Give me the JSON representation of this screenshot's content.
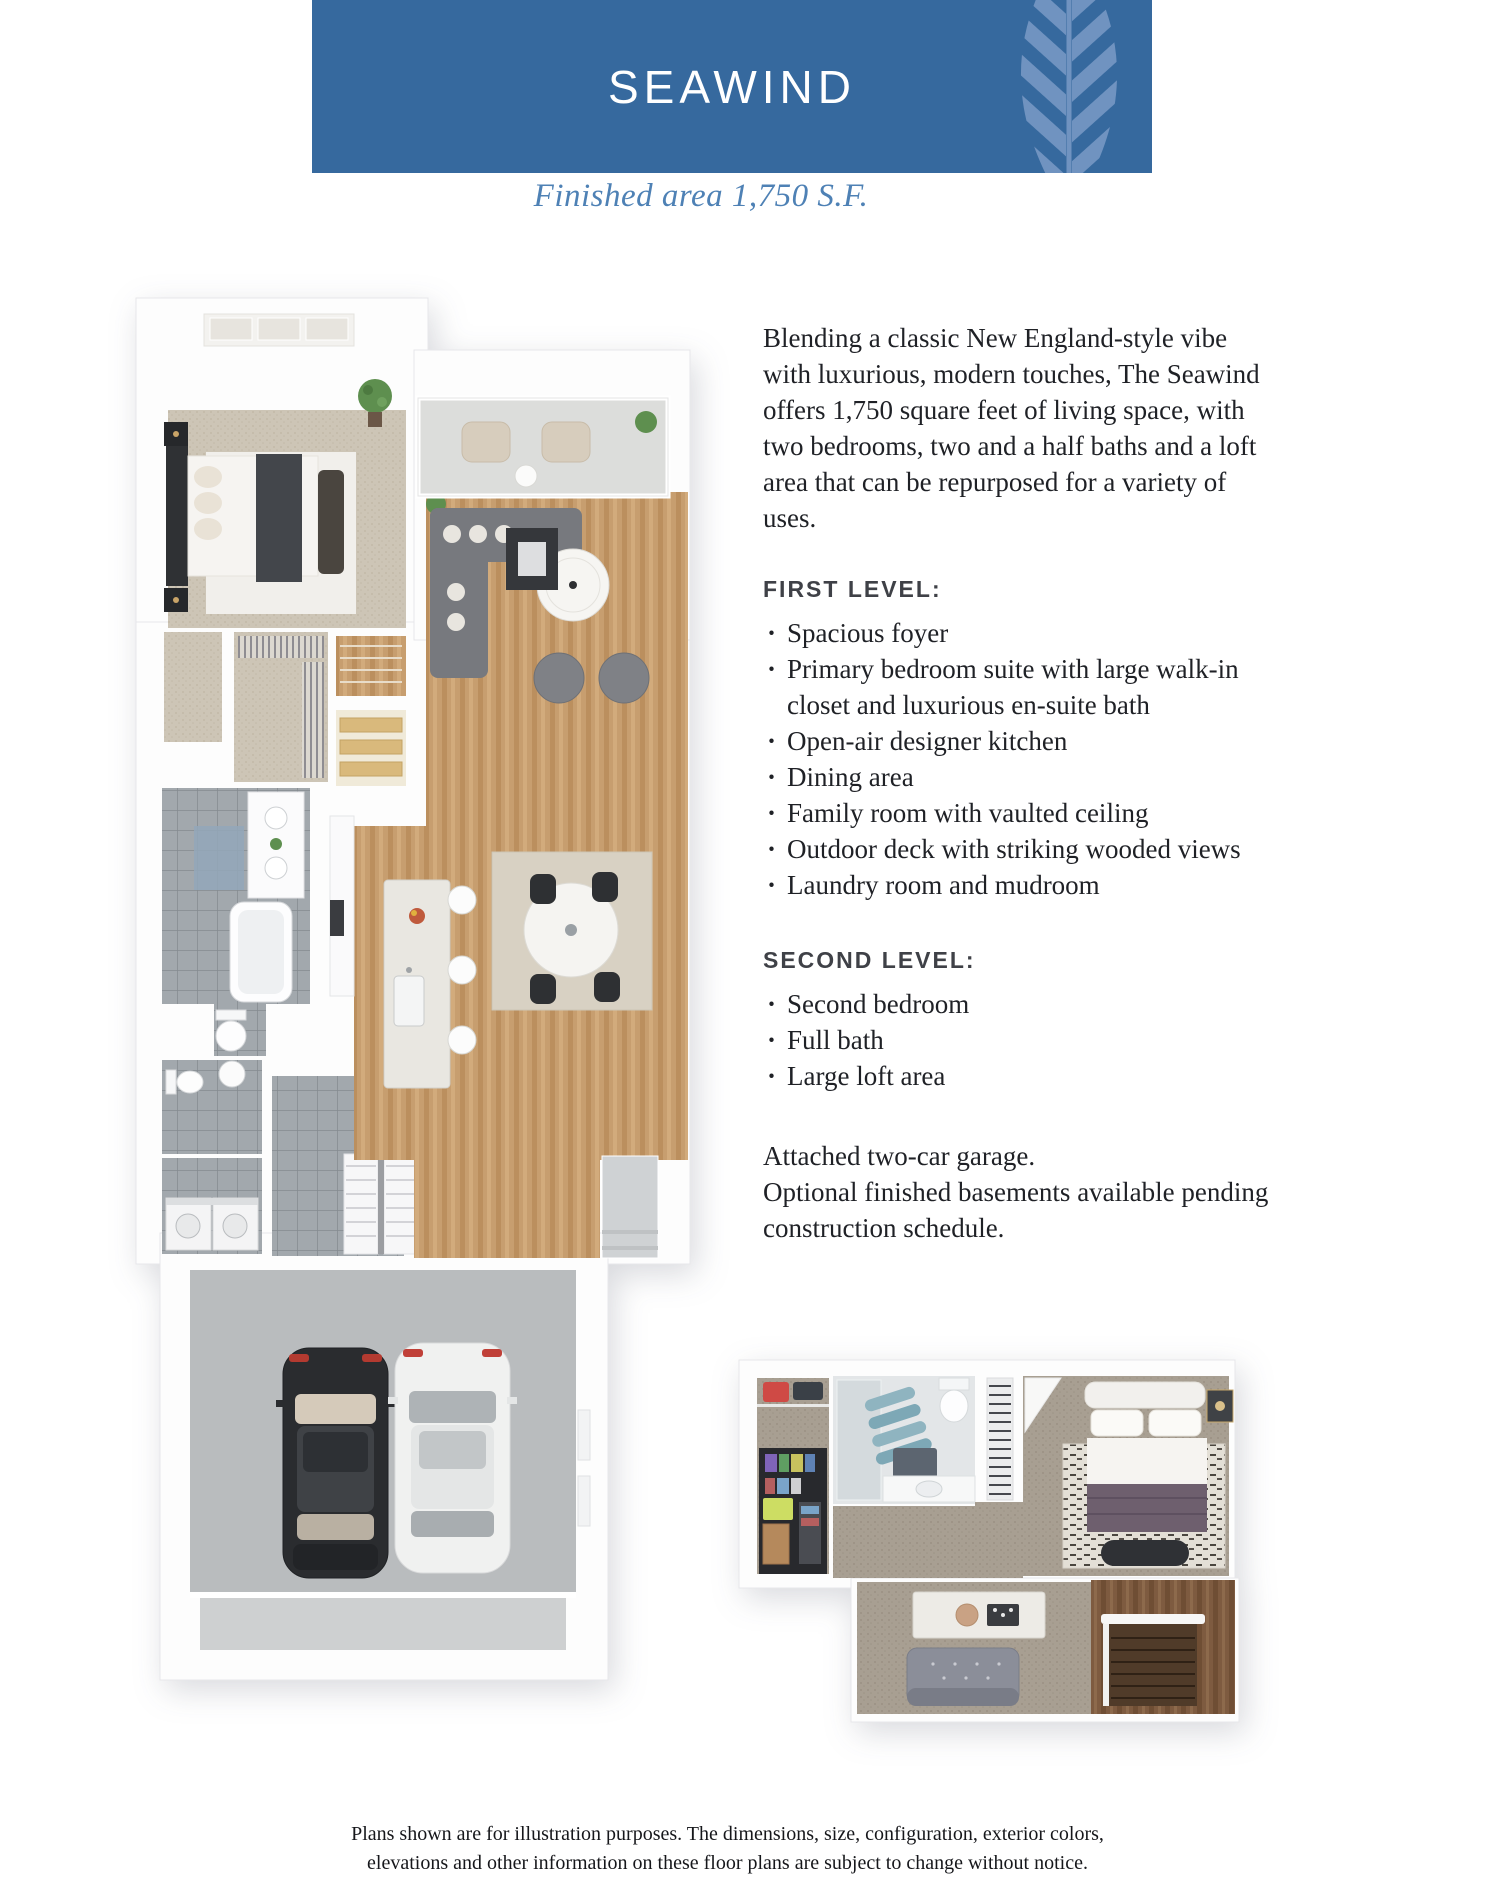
{
  "header": {
    "title": "SEAWIND",
    "subtitle": "Finished area 1,750 S.F."
  },
  "description": {
    "intro": "Blending a classic New England-style vibe with luxurious, modern touches, The Seawind offers 1,750 square feet of living space, with two bedrooms, two and a half baths and a loft area that can be repurposed for a variety of uses.",
    "first_level": {
      "heading": "FIRST LEVEL:",
      "bullets": [
        "Spacious foyer",
        "Primary bedroom suite with large walk-in closet and luxurious en-suite bath",
        "Open-air designer kitchen",
        "Dining area",
        "Family room with vaulted ceiling",
        "Outdoor deck with striking wooded views",
        "Laundry room and mudroom"
      ]
    },
    "second_level": {
      "heading": "SECOND LEVEL:",
      "bullets": [
        "Second bedroom",
        "Full bath",
        "Large loft area"
      ]
    },
    "outro_garage": "Attached two-car garage.",
    "outro_basements": "Optional finished basements available pending construction schedule."
  },
  "floor_plans": {
    "first_level_plan": {
      "type": "3d-floor-plan-rendering",
      "rooms_depicted": [
        "primary bedroom",
        "walk-in closet",
        "en-suite bath",
        "half bath",
        "laundry room",
        "mudroom",
        "staircase",
        "kitchen with island",
        "dining area",
        "family room",
        "outdoor deck",
        "foyer",
        "front porch",
        "attached two-car garage"
      ],
      "garage_contents": [
        "black car",
        "white car"
      ]
    },
    "second_level_plan": {
      "type": "3d-floor-plan-rendering",
      "rooms_depicted": [
        "storage closet",
        "full bath",
        "linen closet",
        "second bedroom",
        "landing",
        "loft area",
        "stairwell"
      ]
    }
  },
  "footer": {
    "line1": "Plans shown are for illustration purposes. The dimensions, size, configuration, exterior colors,",
    "line2": "elevations and other information on these floor plans are subject to change without notice."
  },
  "colors": {
    "banner_blue": "#36699e",
    "leaf_blue": "#7093c0",
    "subtitle_blue": "#4e81b5",
    "body_text": "#1f2126"
  }
}
